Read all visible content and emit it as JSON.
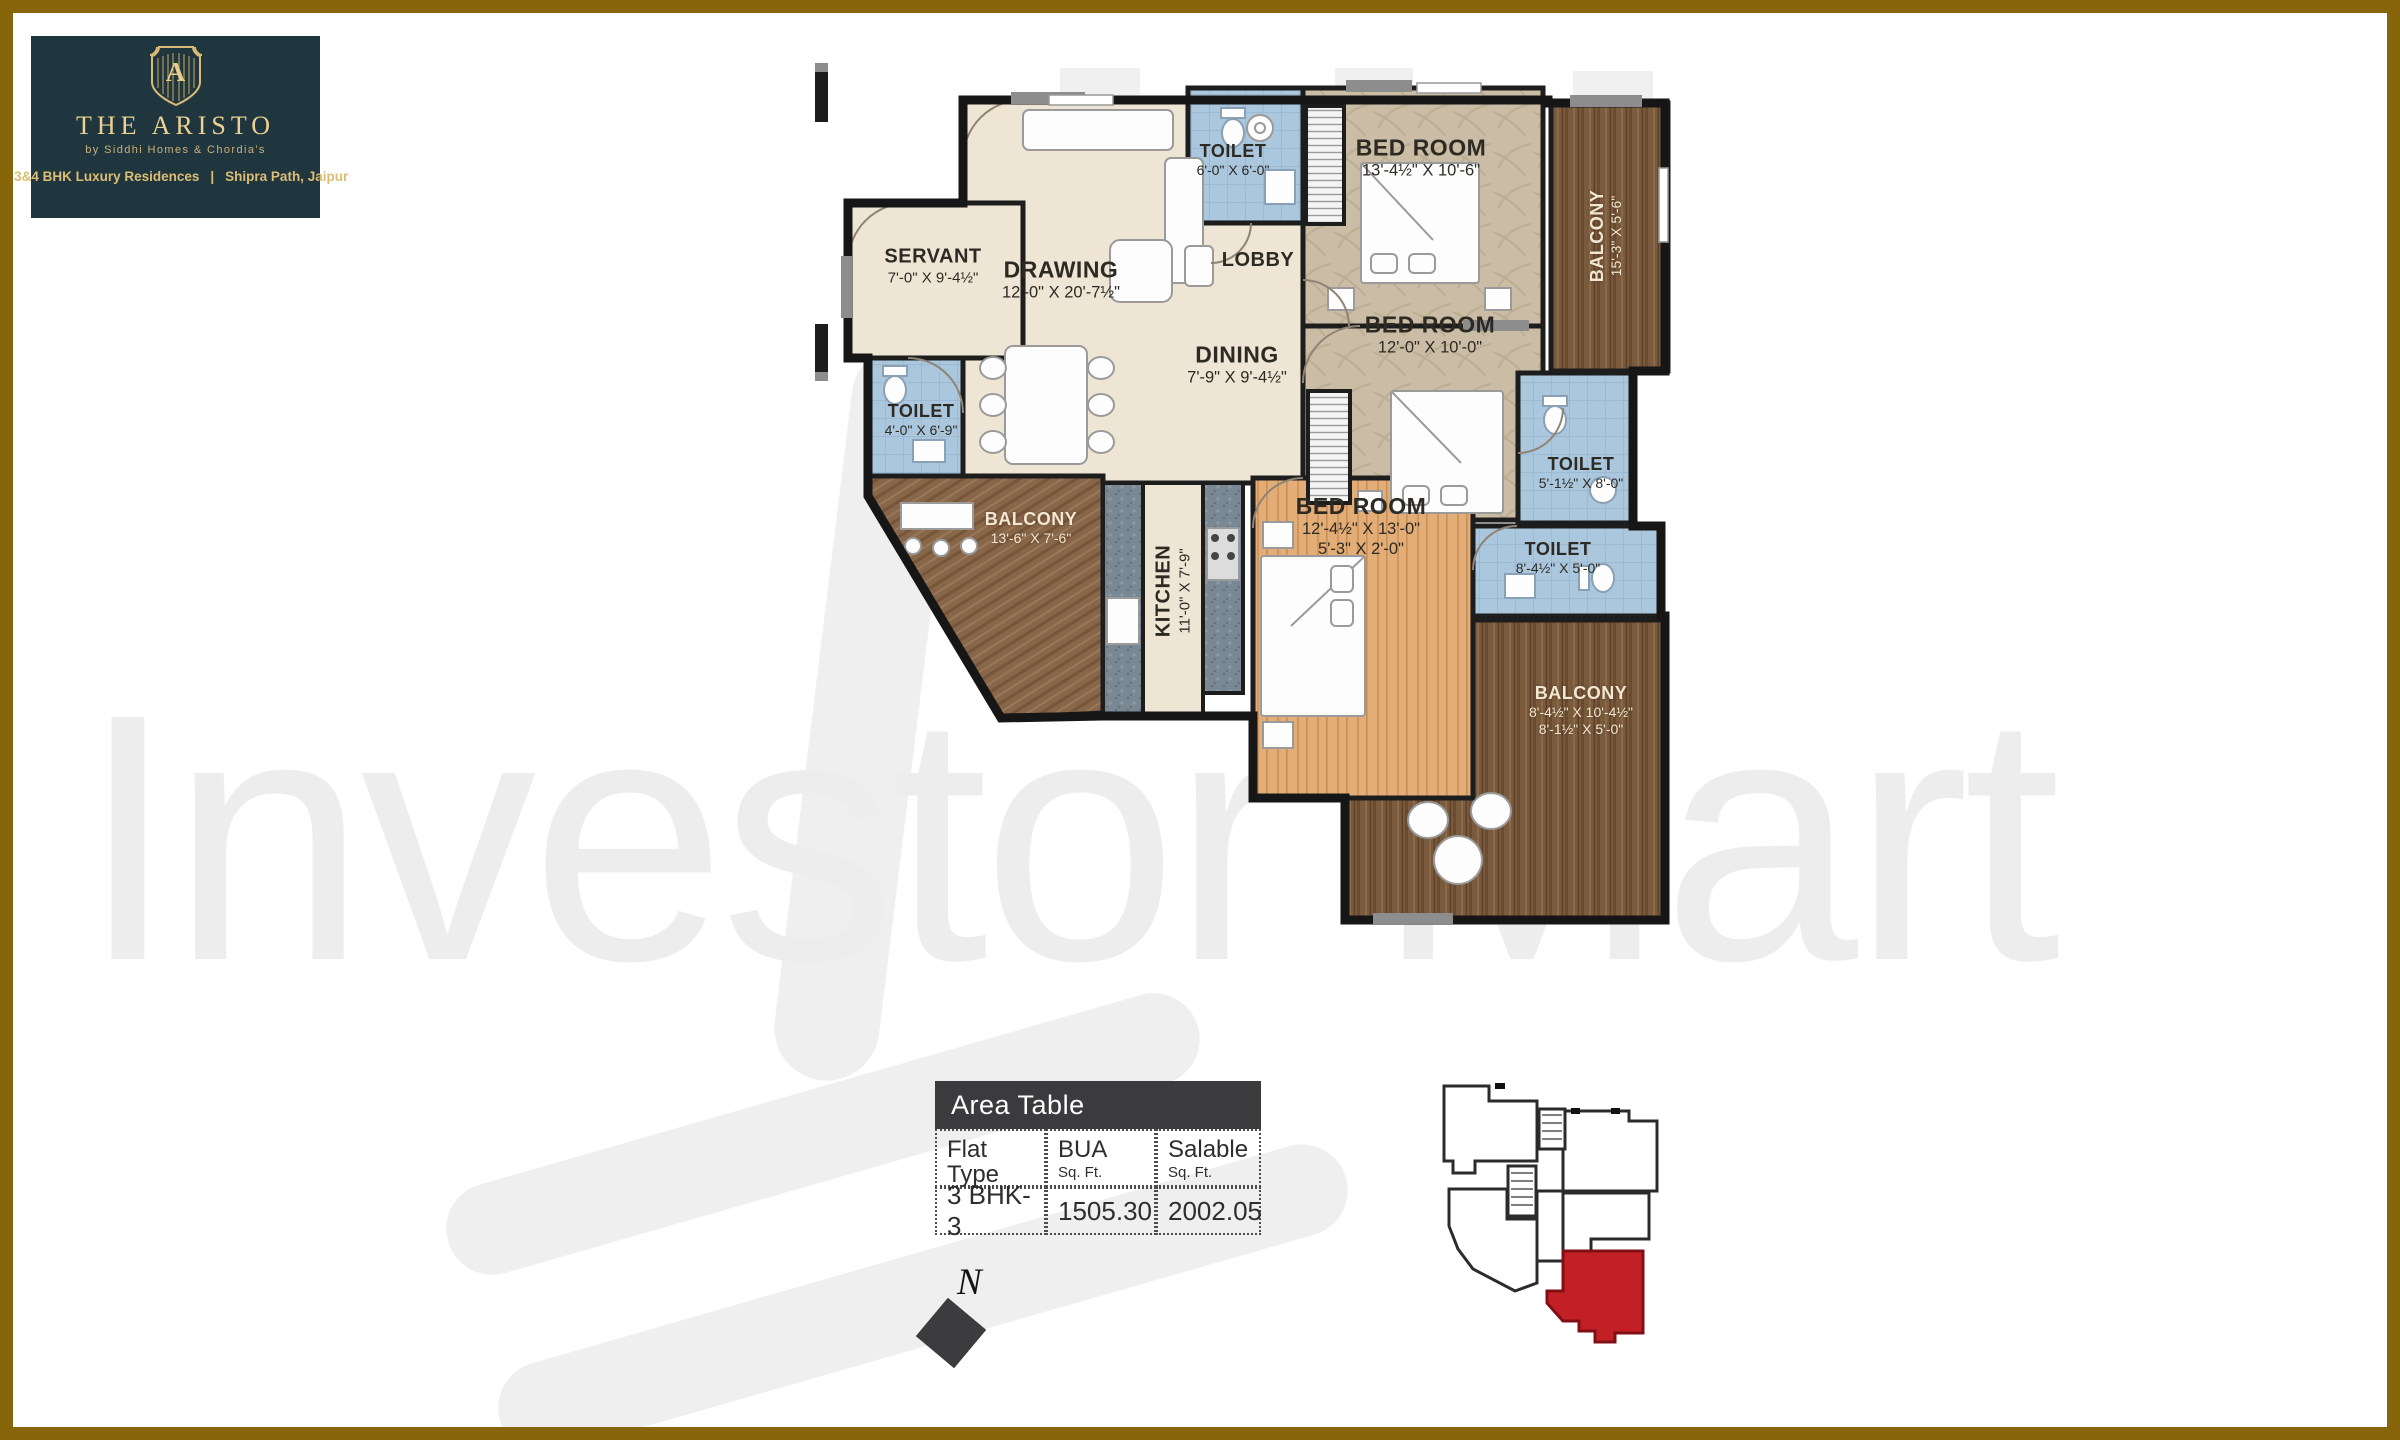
{
  "branding": {
    "monogram": "A",
    "title": "THE ARISTO",
    "tagline": "by Siddhi Homes & Chordia's",
    "line_left": "2,3&4 BHK Luxury Residences",
    "line_sep": "|",
    "line_right": "Shipra Path, Jaipur",
    "panel_color": "#20363f",
    "gold_color": "#ecd193"
  },
  "watermark": {
    "text": "Investor Mart"
  },
  "floor_plan": {
    "rooms": {
      "servant": {
        "name": "SERVANT",
        "dims": "7'-0\" X 9'-4½\""
      },
      "drawing": {
        "name": "DRAWING",
        "dims": "12'-0\" X 20'-7½\""
      },
      "toilet_top": {
        "name": "TOILET",
        "dims": "6'-0\" X 6'-0\""
      },
      "lobby": {
        "name": "LOBBY"
      },
      "dining": {
        "name": "DINING",
        "dims": "7'-9\" X 9'-4½\""
      },
      "bedroom_top": {
        "name": "BED ROOM",
        "dims": "13'-4½\" X 10'-6\""
      },
      "balcony_right": {
        "name": "BALCONY",
        "dims": "15'-3\" X 5'-6\""
      },
      "bedroom_mid": {
        "name": "BED ROOM",
        "dims": "12'-0\" X 10'-0\""
      },
      "toilet_right": {
        "name": "TOILET",
        "dims": "5'-1½\" X 8'-0\""
      },
      "toilet_left": {
        "name": "TOILET",
        "dims": "4'-0\" X 6'-9\""
      },
      "balcony_left": {
        "name": "BALCONY",
        "dims": "13'-6\" X 7'-6\""
      },
      "kitchen": {
        "name": "KITCHEN",
        "dims": "11'-0\" X 7'-9\""
      },
      "bedroom_bottom": {
        "name": "BED ROOM",
        "dims": "12'-4½\" X 13'-0\"",
        "dims2": "5'-3\" X 2'-0\""
      },
      "toilet_bottom": {
        "name": "TOILET",
        "dims": "8'-4½\" X 5'-0\""
      },
      "balcony_bottom": {
        "name": "BALCONY",
        "dims": "8'-4½\" X 10'-4½\"",
        "dims2": "8'-1½\" X 5'-0\""
      }
    }
  },
  "area_table": {
    "title": "Area Table",
    "columns": [
      {
        "label": "Flat Type",
        "sub": ""
      },
      {
        "label": "BUA",
        "sub": "Sq. Ft."
      },
      {
        "label": "Salable",
        "sub": "Sq. Ft."
      }
    ],
    "row": {
      "flat_type": "3 BHK-3",
      "bua": "1505.30",
      "salable": "2002.05"
    }
  },
  "compass": {
    "label": "N"
  },
  "key_plan": {
    "highlight_color": "#c32026"
  }
}
